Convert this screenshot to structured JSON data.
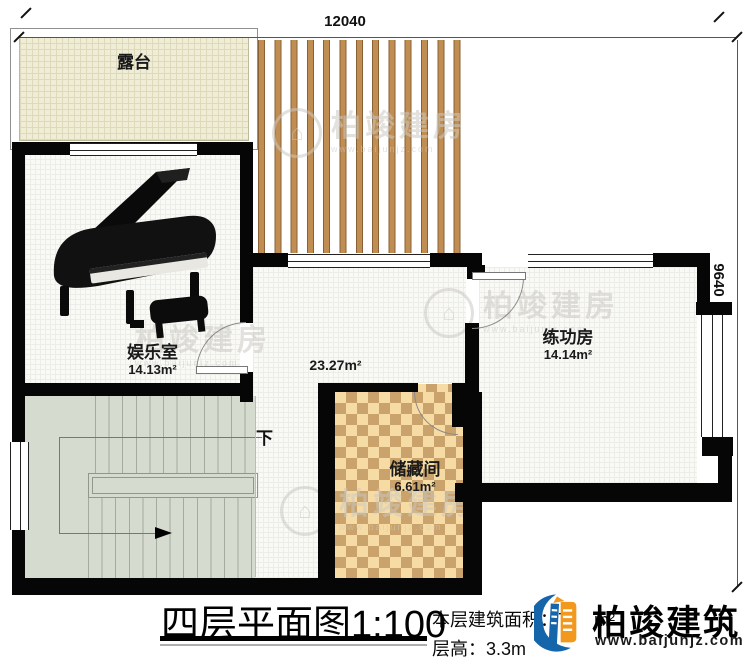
{
  "plan": {
    "dimensions": {
      "width_mm": "12040",
      "height_mm": "9640"
    },
    "rooms": {
      "terrace": {
        "name": "露台"
      },
      "entertainment": {
        "name": "娱乐室",
        "area": "14.13m²"
      },
      "hall": {
        "area": "23.27m²"
      },
      "practice": {
        "name": "练功房",
        "area": "14.14m²"
      },
      "storage": {
        "name": "储藏间",
        "area": "6.61m²"
      }
    },
    "stairs": {
      "direction": "下"
    }
  },
  "title_block": {
    "title": "四层平面图",
    "scale": "1:100",
    "area_label": "本层建筑面积：",
    "area_value_visible": "7",
    "area_unit": "m²",
    "height_label": "层高：",
    "height_value": "3.3m"
  },
  "branding": {
    "company": "柏竣建筑",
    "website": "www.baijunjz.com",
    "watermark": {
      "text": "柏竣建房",
      "subtext": "www.baijunjz.com"
    },
    "colors": {
      "blue": "#1565ab",
      "orange": "#f2991d",
      "wall": "#060606"
    }
  }
}
